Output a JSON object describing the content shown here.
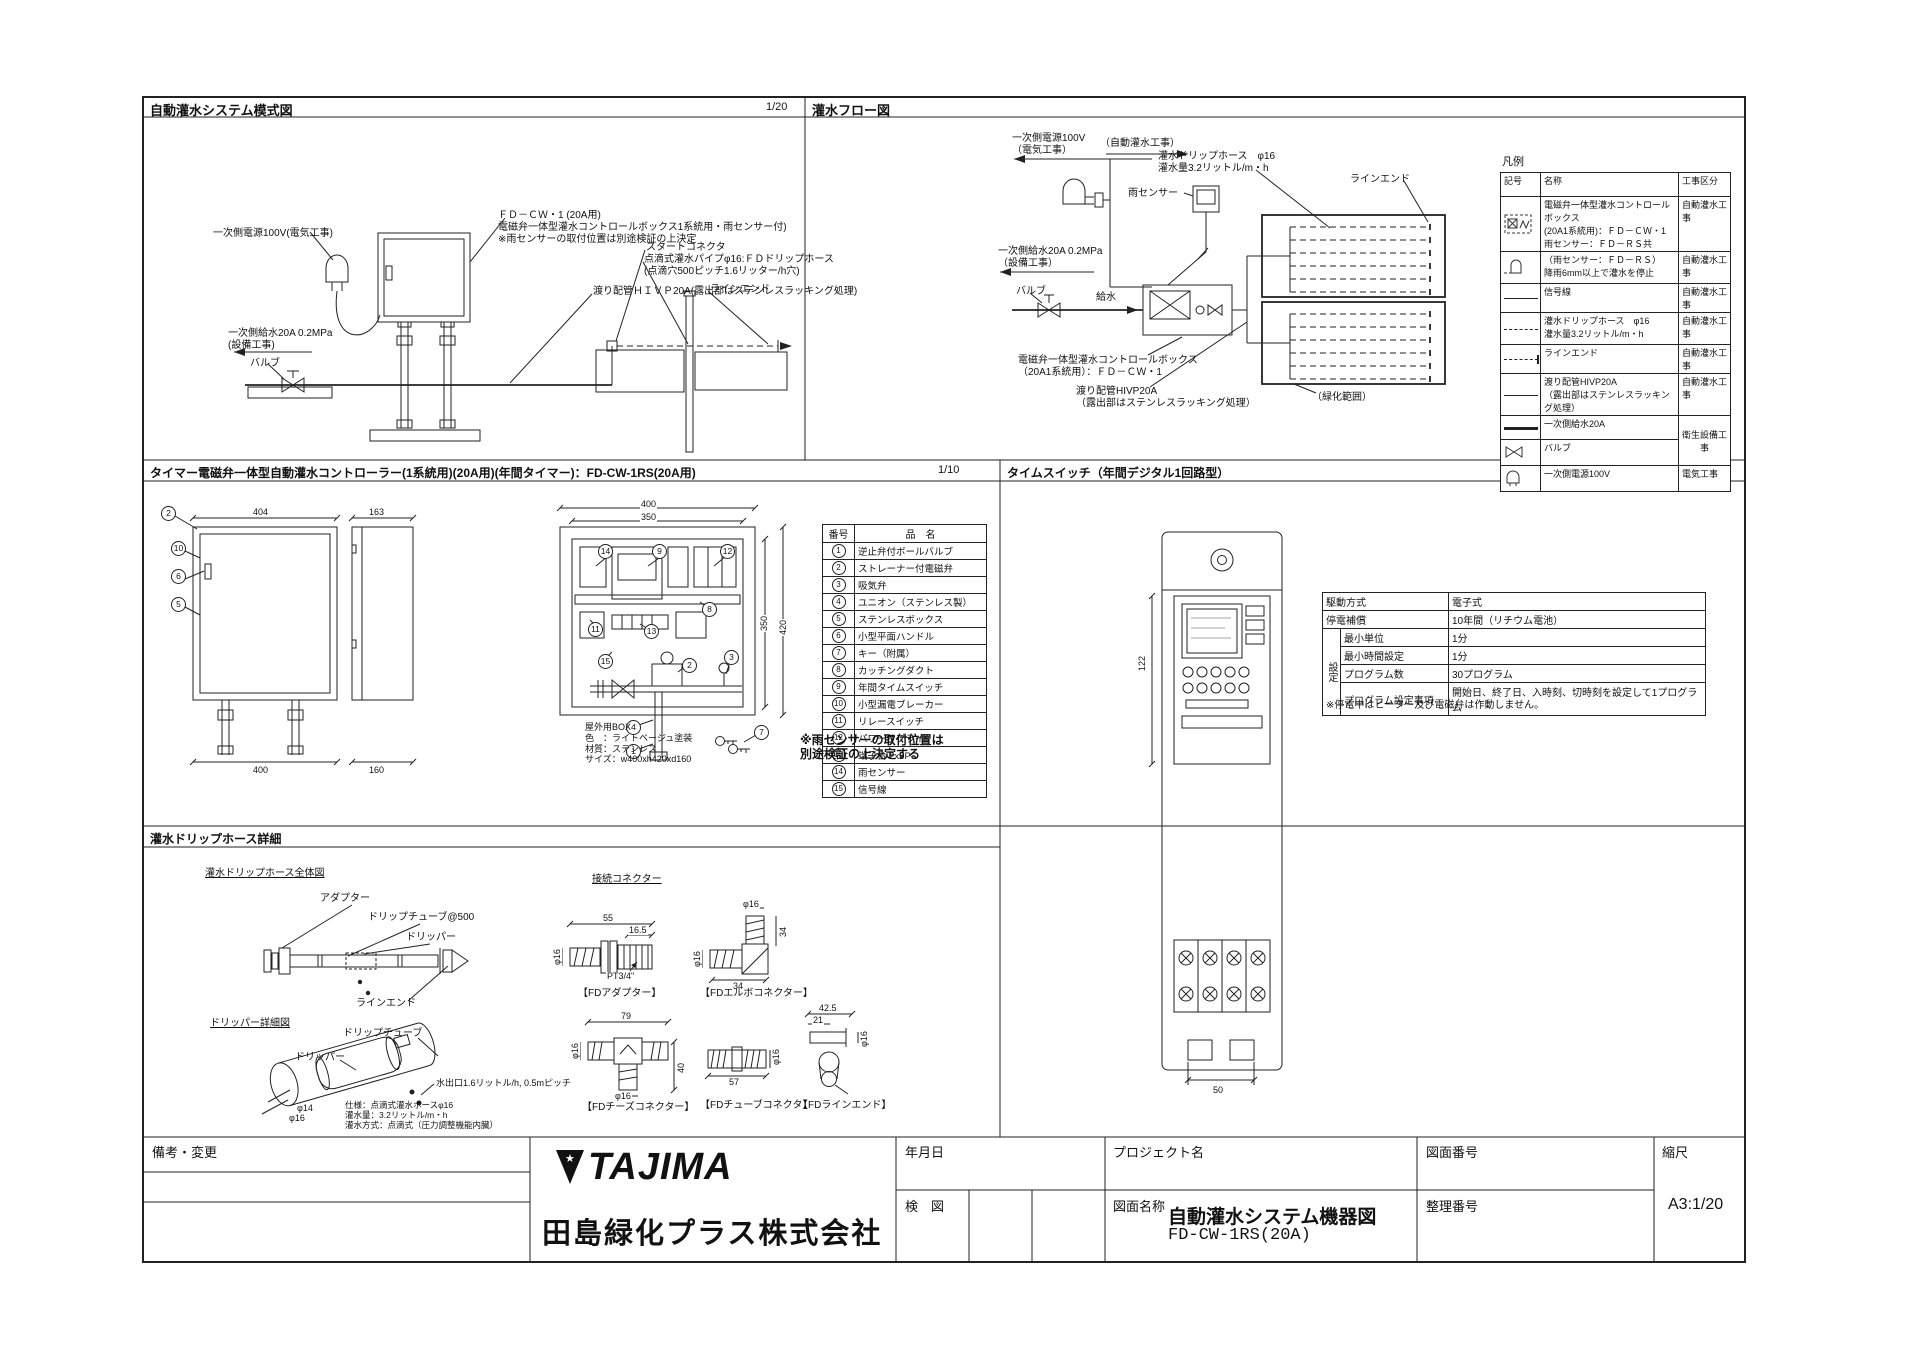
{
  "sheet": {
    "panel1_title": "自動灌水システム模式図",
    "panel1_scale": "1/20",
    "panel2_title": "灌水フロー図",
    "panel3_title": "タイマー電磁弁一体型自動灌水コントローラー(1系統用)(20A用)(年間タイマー)：FD-CW-1RS(20A用)",
    "panel3_scale": "1/10",
    "panel4_title": "タイムスイッチ（年間デジタル1回路型）",
    "panel5_title": "灌水ドリップホース詳細"
  },
  "panel_schematic": {
    "labels": {
      "power_source": "一次側電源100V(電気工事)",
      "controller": "ＦＤ－ＣＷ・1 (20A用)\n電磁弁一体型灌水コントロールボックス1系統用・雨センサー付)\n※雨センサーの取付位置は別途検証の上決定",
      "crossover_pipe": "渡り配管ＨＩＶＰ20A(露出部はステンレスラッキング処理)",
      "water_supply": "一次側給水20A 0.2MPa\n(設備工事)",
      "valve": "バルブ",
      "start_connector": "スタートコネクタ",
      "drip_pipe": "点滴式灌水パイプφ16:ＦＤドリップホース\n(点滴穴500ピッチ1.6リッター/h穴)",
      "line_end": "ラインエンド"
    }
  },
  "panel_flow": {
    "labels": {
      "power": "一次側電源100V\n（電気工事）",
      "auto_work": "（自動灌水工事）",
      "rain_sensor": "雨センサー",
      "drip_hose": "灌水ドリップホース　φ16\n灌水量3.2リットル/m・h",
      "line_end": "ラインエンド",
      "supply": "一次側給水20A 0.2MPa\n（設備工事）",
      "valve": "バルブ",
      "feed": "給水",
      "control_box": "電磁弁一体型灌水コントロールボックス\n（20A1系統用）：ＦＤ－ＣＷ・1",
      "pipe": "渡り配管HIVP20A\n（露出部はステンレスラッキング処理）",
      "green_area": "（緑化範囲）"
    }
  },
  "legend": {
    "title": "凡例",
    "headers": [
      "記号",
      "名称",
      "工事区分"
    ],
    "rows": [
      {
        "symbol": "ctrlbox",
        "name": "電磁弁一体型灌水コントロールボックス\n(20A1系統用)：ＦＤ－ＣＷ・1\n雨センサー：ＦＤ－ＲＳ共",
        "category": "自動灌水工事"
      },
      {
        "symbol": "rain-sensor",
        "name": "（雨センサー：ＦＤ－ＲＳ）\n降雨6mm以上で灌水を停止",
        "category": "自動灌水工事"
      },
      {
        "symbol": "signal-line",
        "name": "信号線",
        "category": "自動灌水工事"
      },
      {
        "symbol": "drip-hose-line",
        "name": "灌水ドリップホース　φ16\n灌水量3.2リットル/m・h",
        "category": "自動灌水工事"
      },
      {
        "symbol": "line-end",
        "name": "ラインエンド",
        "category": "自動灌水工事"
      },
      {
        "symbol": "pipe-line",
        "name": "渡り配管HIVP20A\n（露出部はステンレスラッキング処理）",
        "category": "自動灌水工事"
      },
      {
        "symbol": "supply-line",
        "name": "一次側給水20A",
        "category": "衛生設備工事"
      },
      {
        "symbol": "valve",
        "name": "バルブ",
        "category": ""
      },
      {
        "symbol": "power-plug",
        "name": "一次側電源100V",
        "category": "電気工事"
      }
    ]
  },
  "panel_controller": {
    "dims": {
      "front_top": "404",
      "front_bottom": "400",
      "side_top": "163",
      "side_bottom": "160",
      "inner_top": "400",
      "inner_top2": "350",
      "inner_right": "350",
      "inner_right2": "420"
    },
    "parts": {
      "headers": [
        "番号",
        "品　名"
      ],
      "rows": [
        {
          "no": "1",
          "name": "逆止弁付ボールバルブ"
        },
        {
          "no": "2",
          "name": "ストレーナー付電磁弁"
        },
        {
          "no": "3",
          "name": "吸気弁"
        },
        {
          "no": "4",
          "name": "ユニオン（ステンレス製）"
        },
        {
          "no": "5",
          "name": "ステンレスボックス"
        },
        {
          "no": "6",
          "name": "小型平面ハンドル"
        },
        {
          "no": "7",
          "name": "キー（附属）"
        },
        {
          "no": "8",
          "name": "カッチングダクト"
        },
        {
          "no": "9",
          "name": "年間タイムスイッチ"
        },
        {
          "no": "10",
          "name": "小型漏電ブレーカー"
        },
        {
          "no": "11",
          "name": "リレースイッチ"
        },
        {
          "no": "12",
          "name": "パワーサプライ"
        },
        {
          "no": "13",
          "name": "端子台 2x6P"
        },
        {
          "no": "14",
          "name": "雨センサー"
        },
        {
          "no": "15",
          "name": "信号線"
        }
      ]
    },
    "callouts": {
      "front": [
        "2",
        "10",
        "6",
        "5"
      ],
      "internal": [
        "14",
        "9",
        "12",
        "11",
        "13",
        "8",
        "15",
        "3",
        "2"
      ],
      "pipe": [
        "4",
        "1"
      ],
      "key": "7"
    },
    "note": "※雨センサーの取付位置は\n別途検証の上決定する",
    "box_info": "屋外用BOX\n色　：ライトベージュ塗装\n材質：ステンレス\nサイズ：w400xh420xd160"
  },
  "panel_timeswitch": {
    "spec": {
      "group_label": "設定",
      "rows": [
        {
          "label": "駆動方式",
          "value": "電子式"
        },
        {
          "label": "停電補償",
          "value": "10年間（リチウム電池）"
        },
        {
          "label": "最小単位",
          "value": "1分"
        },
        {
          "label": "最小時間設定",
          "value": "1分"
        },
        {
          "label": "プログラム数",
          "value": "30プログラム"
        },
        {
          "label": "プログラム設定事項",
          "value": "開始日、終了日、入時刻、切時刻を設定して1プログラム"
        }
      ]
    },
    "note": "※停電中はヒーター及び電磁弁は作動しません。",
    "dims": {
      "height": "122",
      "width": "50"
    }
  },
  "panel_driphose": {
    "subtitle_overall": "灌水ドリップホース全体図",
    "subtitle_detail": "ドリッパー詳細図",
    "subtitle_connectors": "接続コネクター",
    "labels": {
      "adapter": "アダプター",
      "tube": "ドリップチューブ@500",
      "dripper": "ドリッパー",
      "line_end": "ラインエンド",
      "detail_tube": "ドリップチューブ",
      "detail_dripper": "ドリッパー",
      "outlet": "水出口1.6リットル/h, 0.5mピッチ",
      "dia14": "φ14",
      "dia16": "φ16"
    },
    "spec": "仕様：点滴式灌水ホースφ16\n灌水量：3.2リットル/m・h\n灌水方式：点滴式（圧力調整機能内臓）",
    "connectors": {
      "adapter": {
        "label": "【FDアダプター】",
        "dim_w": "55",
        "dim_w2": "16.5",
        "dim_d": "φ16",
        "thread": "PT3/4\""
      },
      "elbow": {
        "label": "【FDエルボコネクター】",
        "dim_top": "φ16",
        "dim_right": "34",
        "dim_left": "φ16",
        "dim_bottom": "34"
      },
      "tee": {
        "label": "【FDチーズコネクター】",
        "dim_w": "79",
        "dim_left": "φ16",
        "dim_right": "40",
        "dim_bottom": "φ16"
      },
      "tube": {
        "label": "【FDチューブコネクタ】",
        "dim_d": "φ16",
        "dim_w": "57"
      },
      "line_end": {
        "label": "【FDラインエンド】",
        "dim_w": "42.5",
        "dim_w2": "21",
        "dim_d": "φ16"
      }
    }
  },
  "titleblock": {
    "remarks": "備考・変更",
    "logo": "TAJIMA",
    "company": "田島緑化プラス株式会社",
    "date_label": "年月日",
    "check_label": "検　図",
    "project_label": "プロジェクト名",
    "drawing_title_label": "図面名称",
    "drawing_title": "自動灌水システム機器図",
    "drawing_code": "FD-CW-1RS(20A)",
    "drawing_no_label": "図面番号",
    "ref_no_label": "整理番号",
    "scale_label": "縮尺",
    "scale_value": "A3:1/20"
  }
}
